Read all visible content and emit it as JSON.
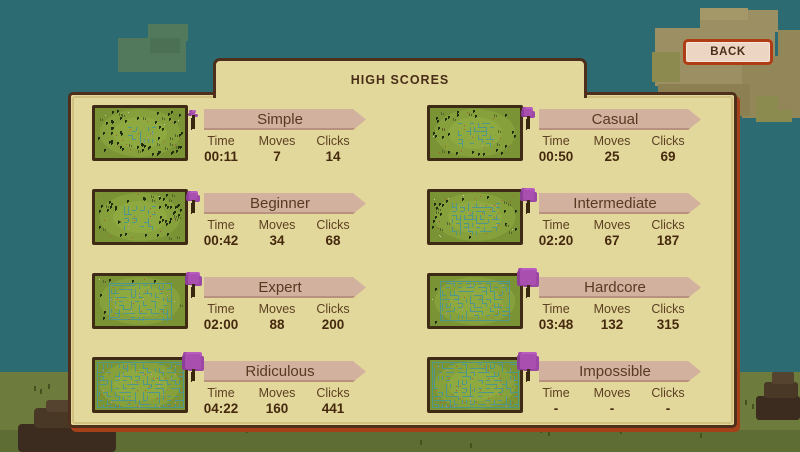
{
  "title": "HIGH SCORES",
  "back_button": {
    "label": "BACK"
  },
  "stat_headers": [
    "Time",
    "Moves",
    "Clicks"
  ],
  "entries": [
    {
      "name": "Simple",
      "time": "00:11",
      "moves": "7",
      "clicks": "14",
      "plant_icon": "sprout",
      "maze": {
        "w": 0.32,
        "h": 0.34,
        "trees": 46
      }
    },
    {
      "name": "Casual",
      "time": "00:50",
      "moves": "25",
      "clicks": "69",
      "plant_icon": "flower",
      "maze": {
        "w": 0.42,
        "h": 0.5,
        "trees": 40
      }
    },
    {
      "name": "Beginner",
      "time": "00:42",
      "moves": "34",
      "clicks": "68",
      "plant_icon": "flower",
      "maze": {
        "w": 0.4,
        "h": 0.52,
        "trees": 42
      }
    },
    {
      "name": "Intermediate",
      "time": "02:20",
      "moves": "67",
      "clicks": "187",
      "plant_icon": "sapling",
      "maze": {
        "w": 0.55,
        "h": 0.66,
        "trees": 34
      }
    },
    {
      "name": "Expert",
      "time": "02:00",
      "moves": "88",
      "clicks": "200",
      "plant_icon": "sapling",
      "maze": {
        "w": 0.7,
        "h": 0.74,
        "trees": 28,
        "frame": true
      }
    },
    {
      "name": "Hardcore",
      "time": "03:48",
      "moves": "132",
      "clicks": "315",
      "plant_icon": "tree",
      "maze": {
        "w": 0.78,
        "h": 0.8,
        "trees": 24,
        "frame": true
      }
    },
    {
      "name": "Ridiculous",
      "time": "04:22",
      "moves": "160",
      "clicks": "441",
      "plant_icon": "tree",
      "maze": {
        "w": 0.97,
        "h": 0.92,
        "trees": 12,
        "frame": true
      }
    },
    {
      "name": "Impossible",
      "time": "-",
      "moves": "-",
      "clicks": "-",
      "plant_icon": "tree",
      "maze": {
        "w": 0.97,
        "h": 0.92,
        "trees": 12,
        "frame": true
      }
    }
  ],
  "colors": {
    "sky": "#2d6b72",
    "grass": "#6d7c3d",
    "grass_dark": "#5e6d33",
    "panel": "#e3d89b",
    "panel_border": "#4e2f1c",
    "panel_accent": "#a4411b",
    "banner": "#d2b19e",
    "back_fill": "#ecd6c3",
    "back_border": "#b03c16",
    "maze_green": "#7a9335",
    "maze_path": "#4f968c",
    "flower_purple": "#a94fb0"
  }
}
